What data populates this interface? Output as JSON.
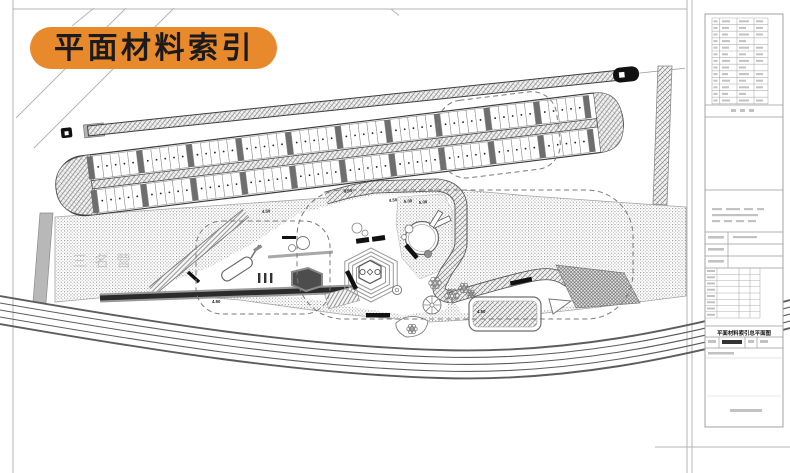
{
  "header": {
    "title": "平面材料索引"
  },
  "watermark": {
    "text": "三名营"
  },
  "plan": {
    "spot_elevations": [
      {
        "text": "4.50"
      },
      {
        "text": "4.50"
      },
      {
        "text": "5.00"
      },
      {
        "text": "5.00"
      },
      {
        "text": "4.50"
      },
      {
        "text": "4.50"
      },
      {
        "text": "4.50"
      }
    ],
    "parking": {
      "groups": 10,
      "stalls_per_group": 5,
      "rows": 2
    }
  },
  "title_block": {
    "drawing_title": "平面材料索引总平面图",
    "revision_rows": 13
  },
  "colors": {
    "accent_orange": "#E8892C",
    "ink": "#1b1b1b",
    "line_gray": "#6b6b6b",
    "stipple_gray": "#9a9a9a"
  }
}
